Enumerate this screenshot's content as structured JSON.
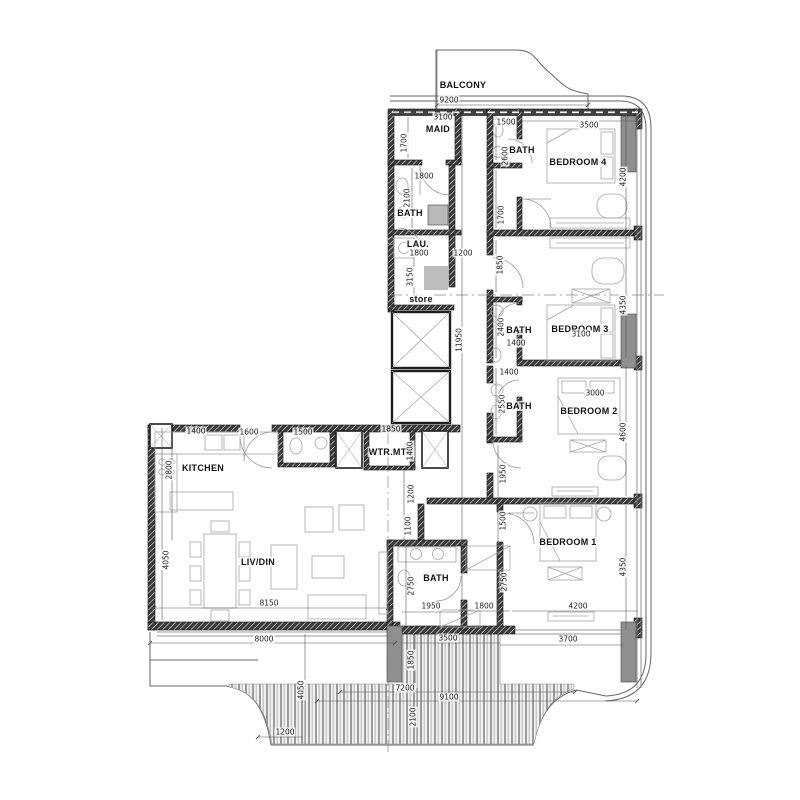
{
  "drawing": {
    "type": "apartment-floor-plan"
  },
  "rooms": [
    {
      "label": "BALCONY",
      "x": 463,
      "y": 85
    },
    {
      "label": "MAID",
      "x": 438,
      "y": 129
    },
    {
      "label": "BATH",
      "x": 410,
      "y": 213
    },
    {
      "label": "LAU.",
      "x": 418,
      "y": 244
    },
    {
      "label": "store",
      "x": 421,
      "y": 299
    },
    {
      "label": "BATH",
      "x": 522,
      "y": 150
    },
    {
      "label": "BEDROOM 4",
      "x": 578,
      "y": 162
    },
    {
      "label": "BATH",
      "x": 519,
      "y": 330
    },
    {
      "label": "BEDROOM 3",
      "x": 580,
      "y": 329
    },
    {
      "label": "BATH",
      "x": 519,
      "y": 406
    },
    {
      "label": "BEDROOM 2",
      "x": 589,
      "y": 411
    },
    {
      "label": "KITCHEN",
      "x": 203,
      "y": 468
    },
    {
      "label": "WTR.MTR",
      "x": 391,
      "y": 452
    },
    {
      "label": "LIV/DIN",
      "x": 258,
      "y": 562
    },
    {
      "label": "BATH",
      "x": 436,
      "y": 578
    },
    {
      "label": "BEDROOM 1",
      "x": 568,
      "y": 542
    }
  ],
  "dimensions": [
    {
      "text": "9200",
      "x": 449,
      "y": 100
    },
    {
      "text": "3100",
      "x": 443,
      "y": 117
    },
    {
      "text": "1500",
      "x": 506,
      "y": 122
    },
    {
      "text": "3500",
      "x": 589,
      "y": 125
    },
    {
      "text": "1700",
      "x": 404,
      "y": 143,
      "v": 1
    },
    {
      "text": "1800",
      "x": 424,
      "y": 176
    },
    {
      "text": "2600",
      "x": 505,
      "y": 156,
      "v": 1
    },
    {
      "text": "4200",
      "x": 623,
      "y": 177,
      "v": 1
    },
    {
      "text": "2100",
      "x": 407,
      "y": 198,
      "v": 1
    },
    {
      "text": "1700",
      "x": 501,
      "y": 215,
      "v": 1
    },
    {
      "text": "1800",
      "x": 419,
      "y": 253
    },
    {
      "text": "1200",
      "x": 463,
      "y": 253
    },
    {
      "text": "3150",
      "x": 410,
      "y": 277,
      "v": 1
    },
    {
      "text": "1850",
      "x": 500,
      "y": 265,
      "v": 1
    },
    {
      "text": "11950",
      "x": 459,
      "y": 340,
      "v": 1
    },
    {
      "text": "4350",
      "x": 623,
      "y": 305,
      "v": 1
    },
    {
      "text": "2400",
      "x": 501,
      "y": 327,
      "v": 1
    },
    {
      "text": "3100",
      "x": 581,
      "y": 334
    },
    {
      "text": "1400",
      "x": 516,
      "y": 343
    },
    {
      "text": "1400",
      "x": 509,
      "y": 372
    },
    {
      "text": "2550",
      "x": 502,
      "y": 404,
      "v": 1
    },
    {
      "text": "3000",
      "x": 595,
      "y": 393
    },
    {
      "text": "4600",
      "x": 623,
      "y": 432,
      "v": 1
    },
    {
      "text": "1400",
      "x": 196,
      "y": 431
    },
    {
      "text": "1600",
      "x": 249,
      "y": 432
    },
    {
      "text": "1500",
      "x": 303,
      "y": 432
    },
    {
      "text": "1850",
      "x": 391,
      "y": 429
    },
    {
      "text": "1400",
      "x": 410,
      "y": 451,
      "v": 1
    },
    {
      "text": "2800",
      "x": 169,
      "y": 470,
      "v": 1
    },
    {
      "text": "1200",
      "x": 411,
      "y": 494,
      "v": 1
    },
    {
      "text": "1100",
      "x": 408,
      "y": 526,
      "v": 1
    },
    {
      "text": "1950",
      "x": 503,
      "y": 474,
      "v": 1
    },
    {
      "text": "1500",
      "x": 503,
      "y": 521,
      "v": 1
    },
    {
      "text": "4050",
      "x": 166,
      "y": 560,
      "v": 1
    },
    {
      "text": "8150",
      "x": 269,
      "y": 603
    },
    {
      "text": "2750",
      "x": 411,
      "y": 586,
      "v": 1
    },
    {
      "text": "2750",
      "x": 504,
      "y": 582,
      "v": 1
    },
    {
      "text": "1950",
      "x": 431,
      "y": 606
    },
    {
      "text": "1800",
      "x": 484,
      "y": 606
    },
    {
      "text": "4200",
      "x": 578,
      "y": 606
    },
    {
      "text": "4350",
      "x": 623,
      "y": 567,
      "v": 1
    },
    {
      "text": "8000",
      "x": 264,
      "y": 639
    },
    {
      "text": "3500",
      "x": 448,
      "y": 638
    },
    {
      "text": "3700",
      "x": 568,
      "y": 639
    },
    {
      "text": "1850",
      "x": 411,
      "y": 660,
      "v": 1
    },
    {
      "text": "7200",
      "x": 405,
      "y": 688
    },
    {
      "text": "9100",
      "x": 449,
      "y": 697
    },
    {
      "text": "2100",
      "x": 413,
      "y": 717,
      "v": 1
    },
    {
      "text": "4050",
      "x": 301,
      "y": 690,
      "v": 1
    },
    {
      "text": "1200",
      "x": 285,
      "y": 732
    }
  ],
  "colors": {
    "wall": "#2f2f2f",
    "column_gray": "#8f8f8f",
    "furniture_line": "#a0a0a0",
    "deck_stripe": "#9b9b9b",
    "dim_line": "#555555",
    "text": "#1c1c1c",
    "background": "#ffffff"
  }
}
